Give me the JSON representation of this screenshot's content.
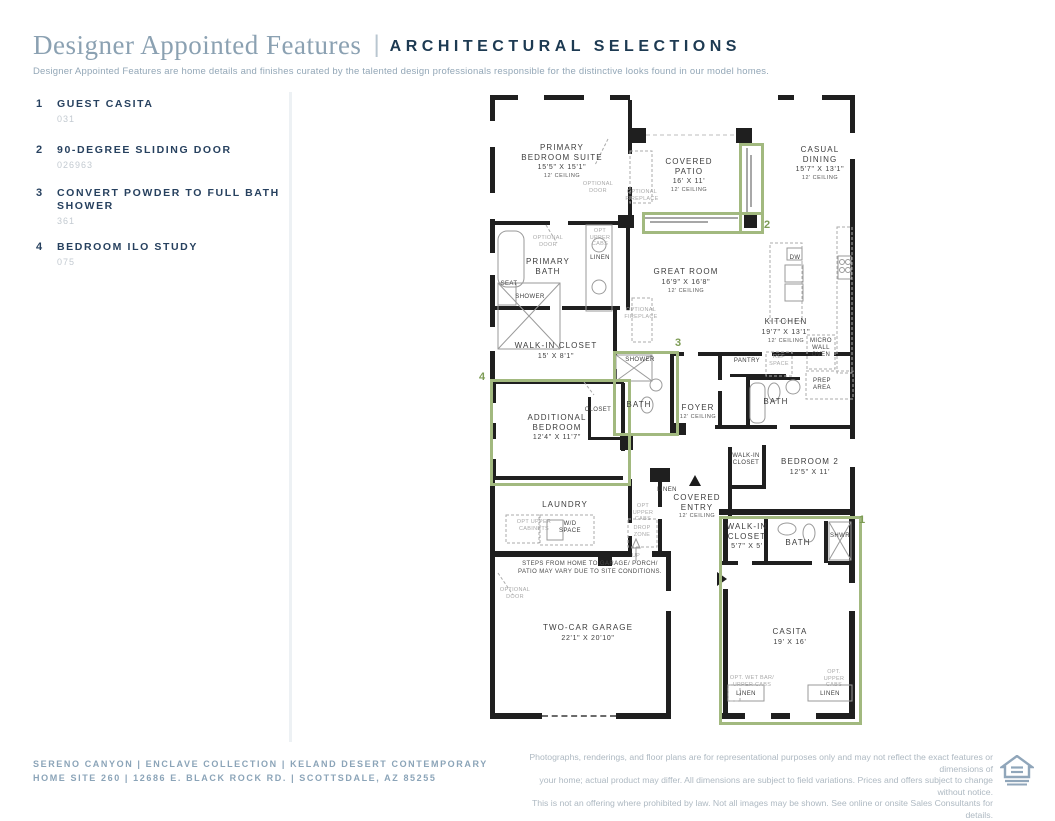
{
  "header": {
    "title": "Designer Appointed Features",
    "separator": "|",
    "subtitle_heading": "ARCHITECTURAL SELECTIONS",
    "description": "Designer Appointed Features are home details and finishes curated by the talented design professionals responsible for the distinctive looks found in our model homes."
  },
  "features": [
    {
      "num": "1",
      "title": "GUEST CASITA",
      "code": "031",
      "top": 0
    },
    {
      "num": "2",
      "title": "90-DEGREE SLIDING DOOR",
      "code": "026963",
      "top": 46
    },
    {
      "num": "3",
      "title": "CONVERT POWDER TO FULL BATH SHOWER",
      "code": "361",
      "top": 89
    },
    {
      "num": "4",
      "title": "BEDROOM ILO STUDY",
      "code": "075",
      "top": 143
    }
  ],
  "floorplan": {
    "labels": [
      {
        "name": "room-primary-bedroom-suite",
        "x": 72,
        "y": 48,
        "lines": [
          [
            "PRIMARY",
            "n"
          ],
          [
            "BEDROOM SUITE",
            "n"
          ],
          [
            "15'5\" X 15'1\"",
            "d"
          ],
          [
            "12' CEILING",
            "c"
          ]
        ]
      },
      {
        "name": "room-covered-patio",
        "x": 199,
        "y": 62,
        "lines": [
          [
            "COVERED",
            "n"
          ],
          [
            "PATIO",
            "n"
          ],
          [
            "16' X 11'",
            "d"
          ],
          [
            "12' CEILING",
            "c"
          ]
        ]
      },
      {
        "name": "room-casual-dining",
        "x": 330,
        "y": 50,
        "lines": [
          [
            "CASUAL",
            "n"
          ],
          [
            "DINING",
            "n"
          ],
          [
            "15'7\" X 13'1\"",
            "d"
          ],
          [
            "12' CEILING",
            "c"
          ]
        ]
      },
      {
        "name": "room-primary-bath",
        "x": 58,
        "y": 162,
        "lines": [
          [
            "PRIMARY",
            "n"
          ],
          [
            "BATH",
            "n"
          ]
        ]
      },
      {
        "name": "room-great-room",
        "x": 196,
        "y": 172,
        "lines": [
          [
            "GREAT ROOM",
            "n"
          ],
          [
            "16'9\" X 16'8\"",
            "d"
          ],
          [
            "12' CEILING",
            "c"
          ]
        ]
      },
      {
        "name": "room-kitchen",
        "x": 296,
        "y": 222,
        "lines": [
          [
            "KITCHEN",
            "n"
          ],
          [
            "19'7\" X 13'1\"",
            "d"
          ],
          [
            "12' CEILING",
            "c"
          ]
        ]
      },
      {
        "name": "room-walk-in-closet",
        "x": 66,
        "y": 246,
        "lines": [
          [
            "WALK-IN CLOSET",
            "n"
          ],
          [
            "15' X 8'1\"",
            "d"
          ]
        ]
      },
      {
        "name": "room-bath-3",
        "x": 149,
        "y": 305,
        "lines": [
          [
            "BATH",
            "n"
          ]
        ]
      },
      {
        "name": "room-foyer",
        "x": 208,
        "y": 308,
        "lines": [
          [
            "FOYER",
            "n"
          ],
          [
            "12' CEILING",
            "c"
          ]
        ]
      },
      {
        "name": "room-bath-2",
        "x": 286,
        "y": 302,
        "lines": [
          [
            "BATH",
            "n"
          ]
        ]
      },
      {
        "name": "room-additional-bedroom",
        "x": 67,
        "y": 318,
        "lines": [
          [
            "ADDITIONAL",
            "n"
          ],
          [
            "BEDROOM",
            "n"
          ],
          [
            "12'4\" X 11'7\"",
            "d"
          ]
        ]
      },
      {
        "name": "room-bedroom-2",
        "x": 320,
        "y": 362,
        "lines": [
          [
            "BEDROOM 2",
            "n"
          ],
          [
            "12'5\" X 11'",
            "d"
          ]
        ]
      },
      {
        "name": "room-bedroom2-closet",
        "x": 256,
        "y": 358,
        "lines": [
          [
            "WALK-IN",
            "s"
          ],
          [
            "CLOSET",
            "s"
          ]
        ]
      },
      {
        "name": "room-laundry",
        "x": 75,
        "y": 405,
        "lines": [
          [
            "LAUNDRY",
            "n"
          ]
        ]
      },
      {
        "name": "room-covered-entry",
        "x": 207,
        "y": 398,
        "lines": [
          [
            "COVERED",
            "n"
          ],
          [
            "ENTRY",
            "n"
          ],
          [
            "12' CEILING",
            "c"
          ]
        ]
      },
      {
        "name": "room-casita-closet",
        "x": 257,
        "y": 427,
        "lines": [
          [
            "WALK-IN",
            "n"
          ],
          [
            "CLOSET",
            "n"
          ],
          [
            "5'7\" X 5'",
            "d"
          ]
        ]
      },
      {
        "name": "room-casita-bath",
        "x": 308,
        "y": 443,
        "lines": [
          [
            "BATH",
            "n"
          ]
        ]
      },
      {
        "name": "room-garage",
        "x": 98,
        "y": 528,
        "lines": [
          [
            "TWO-CAR GARAGE",
            "n"
          ],
          [
            "22'1\" X 20'10\"",
            "d"
          ]
        ]
      },
      {
        "name": "room-casita",
        "x": 300,
        "y": 532,
        "lines": [
          [
            "CASITA",
            "n"
          ],
          [
            "19' X 16'",
            "d"
          ]
        ]
      },
      {
        "name": "label-linen-bath",
        "x": 110,
        "y": 160,
        "lines": [
          [
            "LINEN",
            "s"
          ]
        ]
      },
      {
        "name": "label-shower-bath3",
        "x": 150,
        "y": 262,
        "lines": [
          [
            "SHOWER",
            "s"
          ]
        ]
      },
      {
        "name": "label-closet",
        "x": 108,
        "y": 312,
        "lines": [
          [
            "CLOSET",
            "s"
          ]
        ]
      },
      {
        "name": "label-pantry",
        "x": 257,
        "y": 263,
        "lines": [
          [
            "PANTRY",
            "s"
          ]
        ]
      },
      {
        "name": "label-dw",
        "x": 305,
        "y": 160,
        "lines": [
          [
            "DW",
            "s"
          ]
        ]
      },
      {
        "name": "label-seat",
        "x": 19,
        "y": 186,
        "lines": [
          [
            "SEAT",
            "s"
          ]
        ]
      },
      {
        "name": "label-shower-primary",
        "x": 40,
        "y": 199,
        "lines": [
          [
            "SHOWER",
            "s"
          ]
        ]
      },
      {
        "name": "label-shwr-casita",
        "x": 350,
        "y": 438,
        "lines": [
          [
            "SHWR",
            "s"
          ]
        ]
      },
      {
        "name": "label-wd-space",
        "x": 80,
        "y": 426,
        "lines": [
          [
            "W/D",
            "s"
          ],
          [
            "SPACE",
            "s"
          ]
        ]
      },
      {
        "name": "label-linen-entry",
        "x": 177,
        "y": 392,
        "lines": [
          [
            "LINEN",
            "s"
          ]
        ]
      },
      {
        "name": "label-linen-casita-1",
        "x": 256,
        "y": 596,
        "lines": [
          [
            "LINEN",
            "s"
          ]
        ]
      },
      {
        "name": "label-linen-casita-2",
        "x": 340,
        "y": 596,
        "lines": [
          [
            "LINEN",
            "s"
          ]
        ]
      },
      {
        "name": "label-micro-wall-oven",
        "x": 331,
        "y": 243,
        "lines": [
          [
            "MICRO",
            "s"
          ],
          [
            "WALL",
            "s"
          ],
          [
            "OVEN",
            "s"
          ]
        ]
      },
      {
        "name": "label-prep-area",
        "x": 332,
        "y": 283,
        "lines": [
          [
            "PREP",
            "s"
          ],
          [
            "AREA",
            "s"
          ]
        ]
      },
      {
        "name": "label-ref-space",
        "x": 289,
        "y": 259,
        "lines": [
          [
            "REF",
            "o"
          ],
          [
            "SPACE",
            "o"
          ]
        ]
      },
      {
        "name": "label-up",
        "x": 146,
        "y": 458,
        "lines": [
          [
            "UP",
            "o"
          ]
        ]
      },
      {
        "name": "label-drop-zone",
        "x": 152,
        "y": 430,
        "lines": [
          [
            "DROP",
            "o"
          ],
          [
            "ZONE",
            "o"
          ]
        ]
      },
      {
        "name": "label-optional-door-patio",
        "x": 108,
        "y": 86,
        "lines": [
          [
            "OPTIONAL",
            "o"
          ],
          [
            "DOOR",
            "o"
          ]
        ]
      },
      {
        "name": "label-optional-fireplace-patio",
        "x": 152,
        "y": 94,
        "lines": [
          [
            "OPTIONAL",
            "o"
          ],
          [
            "FIREPLACE",
            "o"
          ]
        ]
      },
      {
        "name": "label-optional-door-bath",
        "x": 58,
        "y": 140,
        "lines": [
          [
            "OPTIONAL",
            "o"
          ],
          [
            "DOOR",
            "o"
          ]
        ]
      },
      {
        "name": "label-opt-upper-cabs-bath",
        "x": 110,
        "y": 133,
        "lines": [
          [
            "OPT",
            "o"
          ],
          [
            "UPPER",
            "o"
          ],
          [
            "CABS",
            "o"
          ]
        ]
      },
      {
        "name": "label-optional-fireplace-gr",
        "x": 151,
        "y": 212,
        "lines": [
          [
            "OPTIONAL",
            "o"
          ],
          [
            "FIREPLACE",
            "o"
          ]
        ]
      },
      {
        "name": "label-opt-upper-cabinets",
        "x": 44,
        "y": 424,
        "lines": [
          [
            "OPT UPPER",
            "o"
          ],
          [
            "CABINETS",
            "o"
          ]
        ]
      },
      {
        "name": "label-opt-upper-cabs-entry",
        "x": 153,
        "y": 408,
        "lines": [
          [
            "OPT",
            "o"
          ],
          [
            "UPPER",
            "o"
          ],
          [
            "CABS",
            "o"
          ]
        ]
      },
      {
        "name": "label-optional-door-garage",
        "x": 25,
        "y": 492,
        "lines": [
          [
            "OPTIONAL",
            "o"
          ],
          [
            "DOOR",
            "o"
          ]
        ]
      },
      {
        "name": "label-opt-wet-bar",
        "x": 262,
        "y": 580,
        "lines": [
          [
            "OPT. WET BAR/",
            "o"
          ],
          [
            "UPPER CABS",
            "o"
          ]
        ]
      },
      {
        "name": "label-opt-upper-cabs-casita",
        "x": 344,
        "y": 574,
        "lines": [
          [
            "OPT.",
            "o"
          ],
          [
            "UPPER",
            "o"
          ],
          [
            "CABS",
            "o"
          ]
        ]
      },
      {
        "name": "label-steps-note",
        "x": 100,
        "y": 465,
        "lines": [
          [
            "STEPS FROM HOME TO GARAGE/ PORCH/",
            "g"
          ],
          [
            "PATIO MAY VARY DUE TO SITE CONDITIONS.",
            "g"
          ]
        ]
      }
    ],
    "feature_boxes": [
      {
        "name": "feature-box-2-horizontal",
        "x": 152,
        "y": 117,
        "w": 116,
        "h": 16
      },
      {
        "name": "feature-box-2-vertical",
        "x": 249,
        "y": 48,
        "w": 19,
        "h": 85
      },
      {
        "name": "feature-box-3",
        "x": 123,
        "y": 256,
        "w": 60,
        "h": 79
      },
      {
        "name": "feature-box-4",
        "x": 0,
        "y": 284,
        "w": 135,
        "h": 101
      },
      {
        "name": "feature-box-1",
        "x": 229,
        "y": 421,
        "w": 137,
        "h": 203
      }
    ],
    "feature_nums": [
      {
        "label": "2",
        "x": 274,
        "y": 124
      },
      {
        "label": "3",
        "x": 185,
        "y": 242
      },
      {
        "label": "4",
        "x": -11,
        "y": 276
      },
      {
        "label": "1",
        "x": 369,
        "y": 419
      }
    ]
  },
  "footer": {
    "community_line": "SERENO CANYON | ENCLAVE COLLECTION | KELAND DESERT CONTEMPORARY",
    "address_line": "HOME SITE 260 | 12686 E. BLACK ROCK RD. | SCOTTSDALE, AZ 85255",
    "disclaimer_lines": [
      "Photographs, renderings, and floor plans are for representational purposes only and may not reflect the exact features or dimensions of",
      "your home; actual product may differ. All dimensions are subject to field variations. Prices and offers subject to change without notice.",
      "This is not an offering where prohibited by law. Not all images may be shown. See online or onsite Sales Consultants for details."
    ],
    "eho_label": "EQUAL HOUSING OPPORTUNITY"
  },
  "colors": {
    "accent_green": "#a2b97f",
    "navy": "#1d3a52",
    "slate_blue": "#8ba1b2",
    "wall_black": "#1f1f1f"
  }
}
